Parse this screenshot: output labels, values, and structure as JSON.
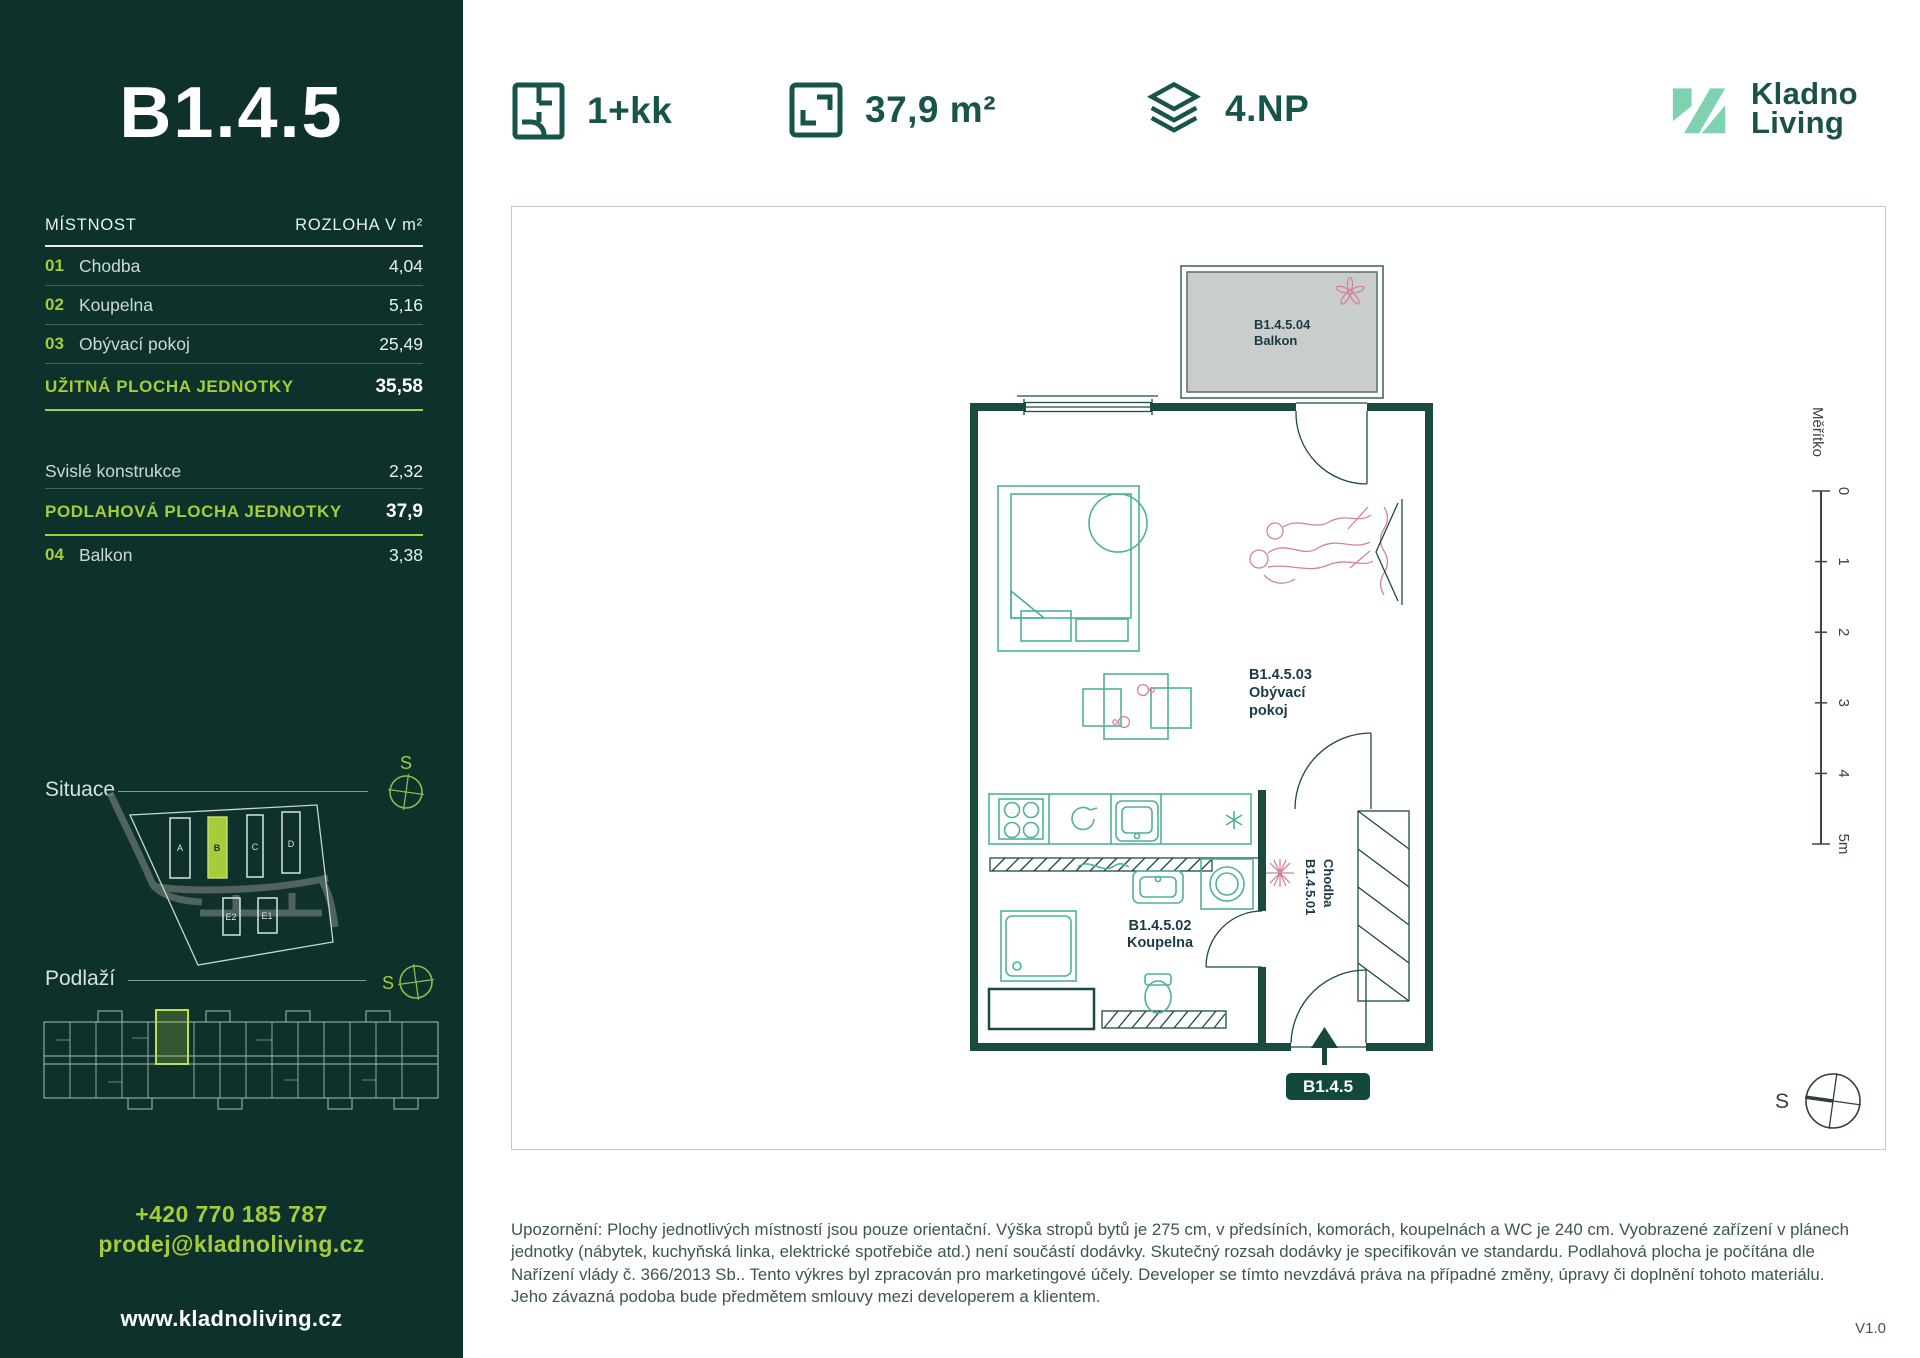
{
  "colors": {
    "sidebar_bg": "#0E312B",
    "lime": "#A5CC3A",
    "mint": "#7FD2B0",
    "teal_dark": "#17544A",
    "wall": "#1B4A41",
    "furniture": "#4FB295",
    "pink": "#D2849C",
    "balcony_gray": "#C9CDCB"
  },
  "sidebar": {
    "unit_code": "B1.4.5",
    "table": {
      "col_room": "MÍSTNOST",
      "col_area": "ROZLOHA V m²",
      "rows": [
        {
          "num": "01",
          "name": "Chodba",
          "area": "4,04"
        },
        {
          "num": "02",
          "name": "Koupelna",
          "area": "5,16"
        },
        {
          "num": "03",
          "name": "Obývací pokoj",
          "area": "25,49"
        }
      ],
      "usable_label": "UŽITNÁ PLOCHA JEDNOTKY",
      "usable_value": "35,58",
      "vertical_label": "Svislé konstrukce",
      "vertical_value": "2,32",
      "floor_label": "PODLAHOVÁ PLOCHA JEDNOTKY",
      "floor_value": "37,9",
      "balcony_row": {
        "num": "04",
        "name": "Balkon",
        "area": "3,38"
      }
    },
    "situace_label": "Situace",
    "situace": {
      "buildings": [
        "A",
        "B",
        "C",
        "D",
        "E2",
        "E1"
      ],
      "compass_letter": "S"
    },
    "podlazi_label": "Podlaží",
    "podlazi": {
      "compass_letter": "S"
    },
    "contact": {
      "phone": "+420 770 185 787",
      "email": "prodej@kladnoliving.cz",
      "web": "www.kladnoliving.cz"
    }
  },
  "header": {
    "layout": "1+kk",
    "area": "37,9 m²",
    "floor": "4.NP",
    "logo_line1": "Kladno",
    "logo_line2": "Living"
  },
  "plan": {
    "balcony_code": "B1.4.5.04",
    "balcony_name": "Balkon",
    "living_code": "B1.4.5.03",
    "living_name1": "Obývací",
    "living_name2": "pokoj",
    "bath_code": "B1.4.5.02",
    "bath_name": "Koupelna",
    "hall_code": "B1.4.5.01",
    "hall_name": "Chodba",
    "badge": "B1.4.5",
    "scale": {
      "label": "Měřítko",
      "ticks": [
        "0",
        "1",
        "2",
        "3",
        "4",
        "5m"
      ]
    },
    "compass_letter": "S"
  },
  "footer": {
    "disclaimer": "Upozornění: Plochy jednotlivých místností jsou pouze orientační. Výška stropů bytů je 275 cm, v předsíních, komorách, koupelnách a WC je 240 cm. Vyobrazené zařízení v plánech jednotky (nábytek, kuchyňská linka, elektrické spotřebiče atd.) není součástí dodávky. Skutečný rozsah dodávky je specifikován ve standardu. Podlahová plocha je počítána dle Nařízení vlády č. 366/2013 Sb.. Tento výkres byl zpracován pro marketingové účely. Developer se tímto nevzdává práva na případné změny, úpravy či doplnění tohoto materiálu. Jeho závazná podoba bude předmětem smlouvy mezi developerem a klientem.",
    "version": "V1.0"
  }
}
